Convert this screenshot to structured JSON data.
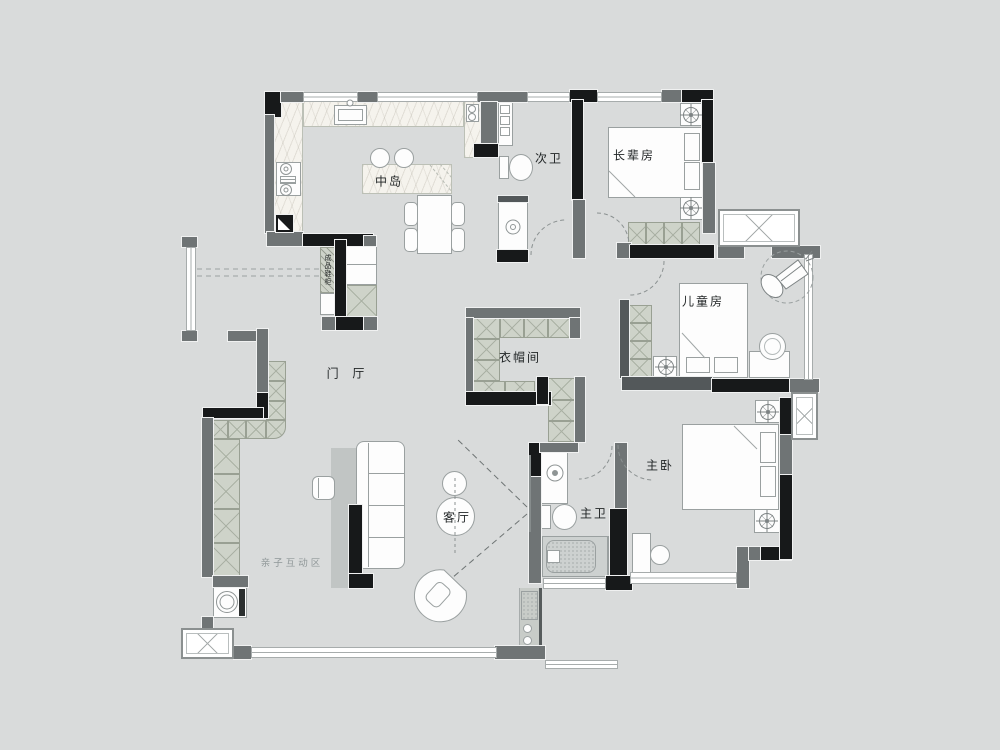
{
  "colors": {
    "background": "#d9dbdb",
    "wall_black": "#17191a",
    "wall_gray": "#6f7475",
    "cabinet_fill": "#ced3c9",
    "counter_marble": "#f5f3ed",
    "furniture_fill": "#fdfdfd",
    "outline_gray": "#9aa0a0",
    "rug_gray": "#c1c5c4",
    "label_text": "#1f2324",
    "label_text_light": "#8f9798"
  },
  "rooms": {
    "island": {
      "label": "中岛"
    },
    "second_bath": {
      "label": "次卫"
    },
    "elder_bedroom": {
      "label": "长辈房"
    },
    "kids_bedroom": {
      "label": "儿童房"
    },
    "cloakroom": {
      "label": "衣帽间"
    },
    "master_bedroom": {
      "label": "主卧"
    },
    "master_bath": {
      "label": "主卫"
    },
    "living_room": {
      "label": "客厅"
    },
    "foyer": {
      "label": "门 厅"
    },
    "kids_play_area": {
      "label": "亲子互动区"
    },
    "shoe_cabinet": {
      "label": "成品鞋柜"
    }
  },
  "symbols": {
    "ceiling_lamp": "crosshair-circle",
    "door_swing": "dashed-arc",
    "ac_platform": "crossed-box",
    "wardrobe": "x-hatched-square",
    "projection_cone": "dashed-lines"
  }
}
